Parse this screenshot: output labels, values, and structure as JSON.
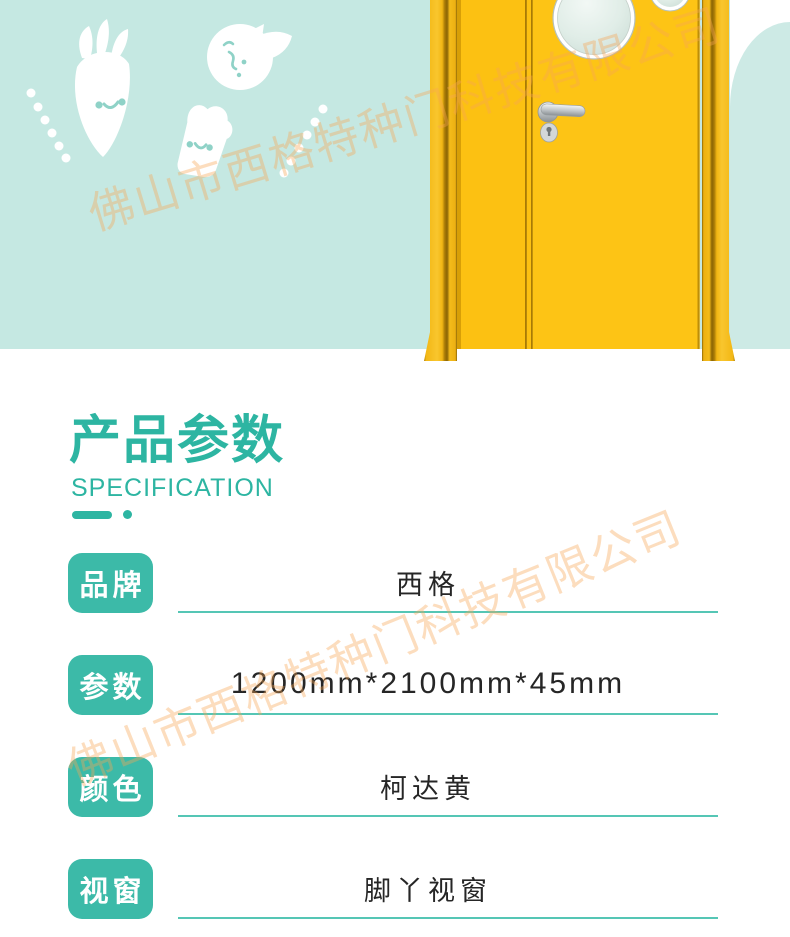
{
  "watermark": {
    "text": "佛山市西格特种门科技有限公司",
    "color": "#f6a653"
  },
  "hero": {
    "background": "#c5e8e2",
    "arch_background": "#cdeae5",
    "decor_icons": [
      "carrot-icon",
      "orange-icon",
      "toast-icon",
      "dot-trail-left-icon",
      "dot-trail-right-icon"
    ],
    "door_icon": "yellow-door-with-porthole-icon",
    "door_color": "#fcc112"
  },
  "section": {
    "title": "产品参数",
    "subtitle": "SPECIFICATION"
  },
  "specs": {
    "rows": [
      {
        "label": "品牌",
        "value": "西格"
      },
      {
        "label": "参数",
        "value": "1200mm*2100mm*45mm"
      },
      {
        "label": "颜色",
        "value": "柯达黄"
      },
      {
        "label": "视窗",
        "value": "脚丫视窗"
      }
    ]
  },
  "colors": {
    "accent": "#2db5a2",
    "badge": "#3cbaa8",
    "underline": "#55c6b5",
    "value_text": "#262626"
  }
}
